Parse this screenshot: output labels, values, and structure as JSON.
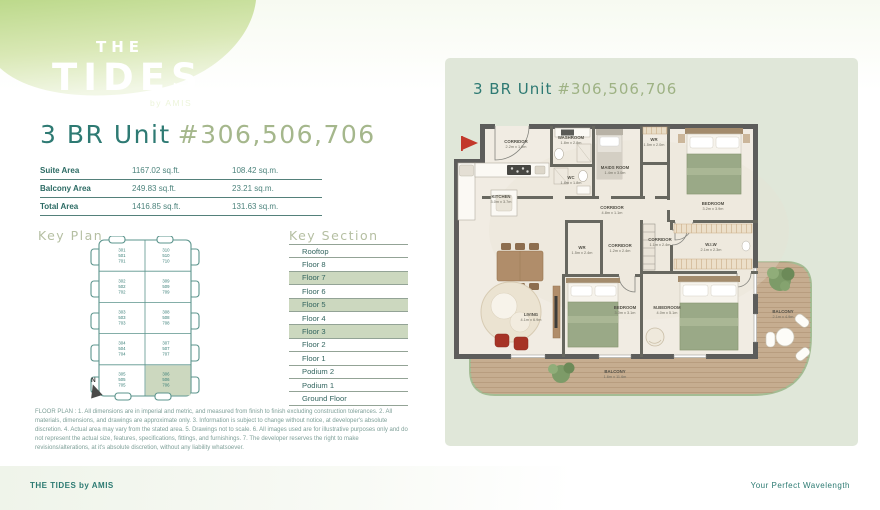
{
  "logo": {
    "line1": "THE",
    "line2": "TIDES",
    "byline": "by AMIS"
  },
  "header": {
    "title_prefix": "3 BR Unit",
    "title_number": "#306,506,706"
  },
  "area_table": {
    "rows": [
      {
        "label": "Suite Area",
        "sqft": "1167.02 sq.ft.",
        "sqm": "108.42 sq.m."
      },
      {
        "label": "Balcony Area",
        "sqft": "249.83 sq.ft.",
        "sqm": "23.21 sq.m."
      },
      {
        "label": "Total Area",
        "sqft": "1416.85 sq.ft.",
        "sqm": "131.63 sq.m."
      }
    ]
  },
  "key_plan": {
    "heading": "Key Plan",
    "north_label": "N",
    "units_left": [
      [
        "301",
        "501",
        "701"
      ],
      [
        "302",
        "502",
        "702"
      ],
      [
        "303",
        "503",
        "703"
      ],
      [
        "304",
        "504",
        "704"
      ],
      [
        "305",
        "505",
        "705"
      ]
    ],
    "units_right": [
      [
        "310",
        "510",
        "710"
      ],
      [
        "309",
        "509",
        "709"
      ],
      [
        "308",
        "508",
        "708"
      ],
      [
        "307",
        "507",
        "707"
      ],
      [
        "306",
        "506",
        "706"
      ]
    ],
    "highlighted_unit": "306,506,706"
  },
  "key_section": {
    "heading": "Key Section",
    "floors": [
      {
        "label": "Rooftop",
        "highlighted": false
      },
      {
        "label": "Floor 8",
        "highlighted": false
      },
      {
        "label": "Floor 7",
        "highlighted": true
      },
      {
        "label": "Floor 6",
        "highlighted": false
      },
      {
        "label": "Floor 5",
        "highlighted": true
      },
      {
        "label": "Floor 4",
        "highlighted": false
      },
      {
        "label": "Floor 3",
        "highlighted": true
      },
      {
        "label": "Floor 2",
        "highlighted": false
      },
      {
        "label": "Floor 1",
        "highlighted": false
      },
      {
        "label": "Podium 2",
        "highlighted": false
      },
      {
        "label": "Podium 1",
        "highlighted": false
      },
      {
        "label": "Ground Floor",
        "highlighted": false
      }
    ]
  },
  "floor_plan": {
    "title_prefix": "3 BR Unit",
    "title_number": "#306,506,706",
    "entrance_marker": "entrance-flag",
    "rooms": [
      {
        "id": "corridor-entrance",
        "name": "CORRIDOR",
        "dims": "2.2m x 1.0m"
      },
      {
        "id": "washroom",
        "name": "WASHROOM",
        "dims": "1.8m x 2.8m"
      },
      {
        "id": "wc",
        "name": "WC",
        "dims": "1.8m x 1.8m"
      },
      {
        "id": "maids-room",
        "name": "MAIDS ROOM",
        "dims": "1.4m x 3.0m"
      },
      {
        "id": "wr-top",
        "name": "WR",
        "dims": "1.5m x 2.0m"
      },
      {
        "id": "bedroom-top",
        "name": "BEDROOM",
        "dims": "3.2m x 3.9m"
      },
      {
        "id": "corridor-main",
        "name": "CORRIDOR",
        "dims": "4.8m x 1.1m"
      },
      {
        "id": "kitchen",
        "name": "KITCHEN",
        "dims": "3.0m x 3.7m"
      },
      {
        "id": "wr-small",
        "name": "WR",
        "dims": "1.5m x 2.4m"
      },
      {
        "id": "corridor-2",
        "name": "CORRIDOR",
        "dims": "1.2m x 2.4m"
      },
      {
        "id": "corridor-3",
        "name": "CORRIDOR",
        "dims": "1.1m x 2.4m"
      },
      {
        "id": "wiw",
        "name": "W.I.W",
        "dims": "2.1m x 2.3m"
      },
      {
        "id": "living",
        "name": "LIVING",
        "dims": "4.1m x 6.9m"
      },
      {
        "id": "bedroom-bottom",
        "name": "BEDROOM",
        "dims": "3.0m x 3.1m"
      },
      {
        "id": "m-bedroom",
        "name": "M.BEDROOM",
        "dims": "4.0m x 5.1m"
      },
      {
        "id": "balcony-right",
        "name": "BALCONY",
        "dims": "2.1m x 4.9m"
      },
      {
        "id": "balcony-bottom",
        "name": "BALCONY",
        "dims": "1.6m x 11.6m"
      }
    ]
  },
  "disclaimer": "FLOOR PLAN : 1. All dimensions are in imperial and metric, and measured from finish to finish excluding construction tolerances. 2. All materials, dimensions, and drawings are approximate only. 3. Information is subject to change without notice, at developer's absolute discretion. 4. Actual area may vary from the stated area. 5. Drawings not to scale. 6. All images used are for illustrative purposes only and do not represent the actual size, features, specifications, fittings, and furnishings. 7. The developer reserves the right to make revisions/alterations, at it's absolute discretion, without any liability whatsoever.",
  "footer": {
    "left": "THE TIDES by AMIS",
    "right": "Your Perfect Wavelength"
  },
  "colors": {
    "teal": "#2e7a73",
    "olive": "#a5b78c",
    "heading_olive": "#b5bfa2",
    "sage_panel": "#e0e7d9",
    "sage_highlight": "#ccd8bf",
    "wall": "#5d5d5b",
    "floor": "#f1ece3",
    "deck": "#c6ad90",
    "deck_outline": "#a4bd94",
    "bed_green": "#9aa987",
    "wood": "#b08d6a",
    "accent_red": "#c2392b"
  }
}
